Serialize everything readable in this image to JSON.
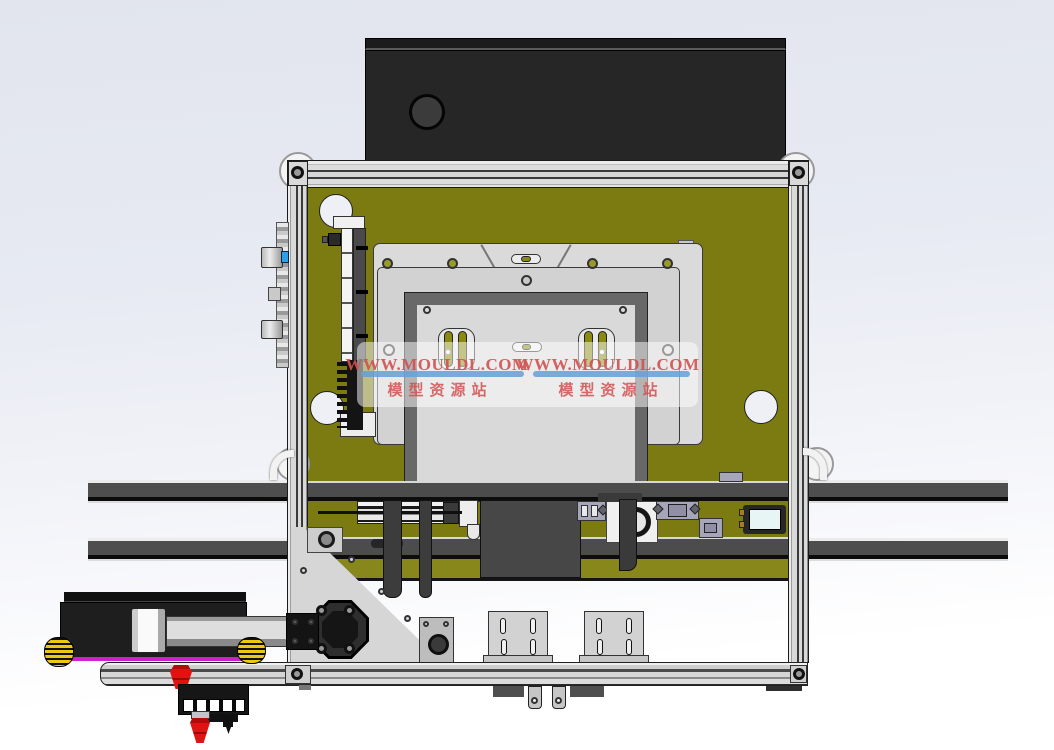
{
  "watermark": {
    "url": "WWW.MOULDL.COM",
    "site_name": "模型资源站",
    "text_color": "#d25050",
    "underline_color": "#64a0d7"
  },
  "palette": {
    "background_top": "#e2e5ee",
    "background_bottom": "#ffffff",
    "panel_olive": "#7b7b12",
    "panel_olive_light": "#87871c",
    "frame_aluminum": "#d9d9d9",
    "housing_black": "#242424",
    "rail_gray": "#4e4e4e",
    "plate_gray": "#dadada",
    "clamp_frame_gray": "#686868",
    "sensor_purple": "#a6a6ba",
    "roller_yellow": "#edc90a",
    "nozzle_red": "#e01212",
    "carriage_magenta": "#cc22cc",
    "sight_glass_cyan": "#e7f6f4"
  }
}
